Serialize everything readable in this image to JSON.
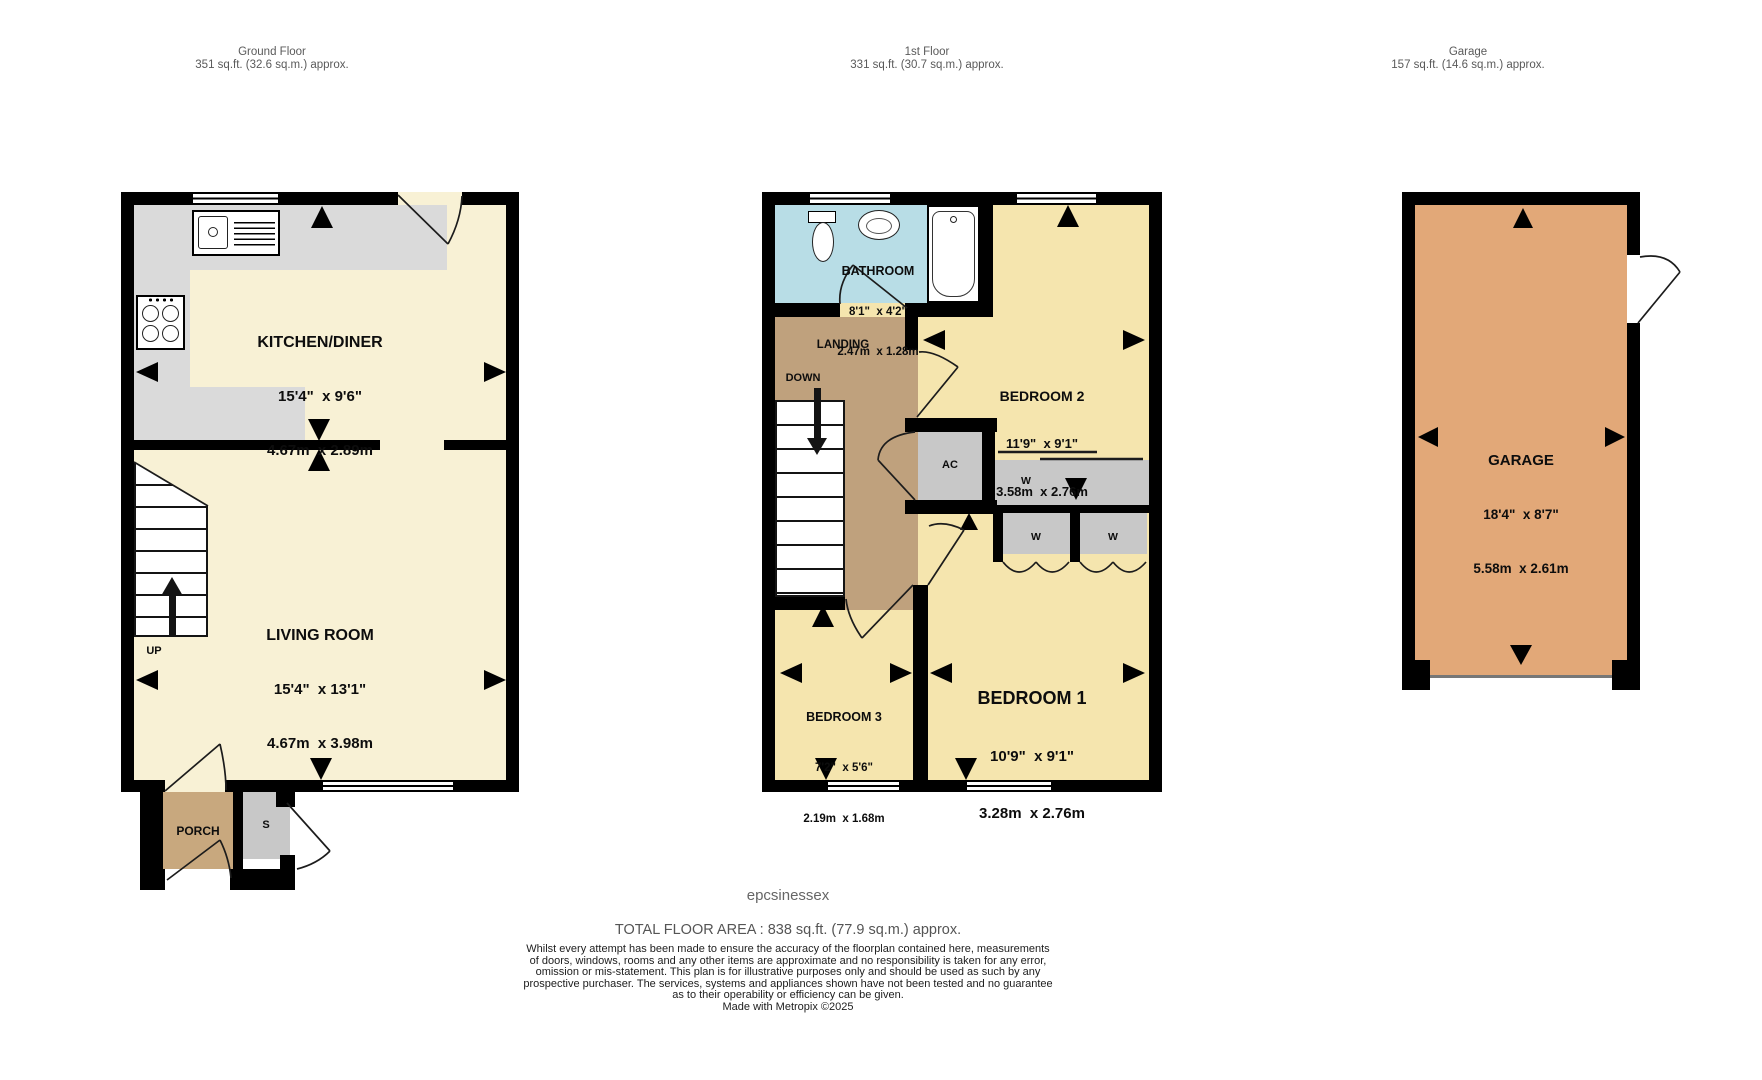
{
  "header": {
    "ground": {
      "title": "Ground Floor",
      "area": "351 sq.ft. (32.6 sq.m.) approx."
    },
    "first": {
      "title": "1st Floor",
      "area": "331 sq.ft. (30.7 sq.m.) approx."
    },
    "garage": {
      "title": "Garage",
      "area": "157 sq.ft. (14.6 sq.m.) approx."
    }
  },
  "ground_floor": {
    "kitchen": {
      "name": "KITCHEN/DINER",
      "imperial": "15'4\"  x 9'6\"",
      "metric": "4.67m  x 2.89m"
    },
    "living": {
      "name": "LIVING ROOM",
      "imperial": "15'4\"  x 13'1\"",
      "metric": "4.67m  x 3.98m"
    },
    "stairs_label": "UP",
    "porch": "PORCH",
    "store": "S"
  },
  "first_floor": {
    "bathroom": {
      "name": "BATHROOM",
      "imperial": "8'1\"  x 4'2\"",
      "metric": "2.47m  x 1.28m"
    },
    "landing": "LANDING",
    "stairs_label": "DOWN",
    "bedroom1": {
      "name": "BEDROOM 1",
      "imperial": "10'9\"  x 9'1\"",
      "metric": "3.28m  x 2.76m"
    },
    "bedroom2": {
      "name": "BEDROOM 2",
      "imperial": "11'9\"  x 9'1\"",
      "metric": "3.58m  x 2.76m"
    },
    "bedroom3": {
      "name": "BEDROOM 3",
      "imperial": "7'2\"  x 5'6\"",
      "metric": "2.19m  x 1.68m"
    },
    "ac": "AC",
    "wardrobe": "W"
  },
  "garage_plan": {
    "name": "GARAGE",
    "imperial": "18'4\"  x 8'7\"",
    "metric": "5.58m  x 2.61m"
  },
  "footer": {
    "brand": "epcsinessex",
    "total": "TOTAL FLOOR AREA : 838 sq.ft. (77.9 sq.m.) approx.",
    "disclaimer": "Whilst every attempt has been made to ensure the accuracy of the floorplan contained here, measurements\nof doors, windows, rooms and any other items are approximate and no responsibility is taken for any error,\nomission or mis-statement. This plan is for illustrative purposes only and should be used as such by any\nprospective purchaser. The services, systems and appliances shown have not been tested and no guarantee\nas to their operability or efficiency can be given.\nMade with Metropix ©2025"
  },
  "colors": {
    "wall": "#000000",
    "ground_room": "#f8f1d5",
    "bedroom": "#f5e5ae",
    "bathroom": "#b8dde6",
    "landing": "#bfa17d",
    "porch": "#c8a87e",
    "counter_gray": "#dadada",
    "closet_gray": "#c8c8c8",
    "garage": "#e2a878",
    "label_gray": "#5a5a5a"
  }
}
